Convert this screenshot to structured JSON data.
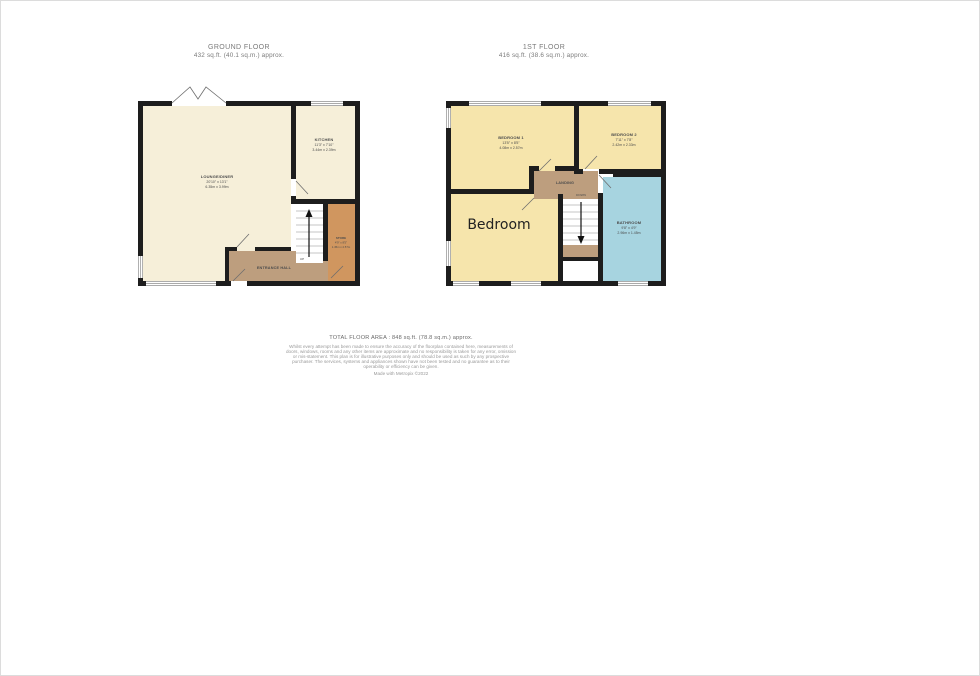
{
  "ground_floor": {
    "title": "GROUND FLOOR",
    "subtitle": "432 sq.ft. (40.1 sq.m.) approx.",
    "rooms": {
      "lounge": {
        "name": "LOUNGE/DINER",
        "imperial": "20'10\" x 13'1\"",
        "metric": "6.35m x 3.99m"
      },
      "kitchen": {
        "name": "KITCHEN",
        "imperial": "11'3\" x 7'10\"",
        "metric": "3.44m x 2.39m"
      },
      "entrance_hall": {
        "name": "ENTRANCE HALL"
      },
      "store": {
        "name": "STORE",
        "imperial": "4'9\" x 8'5\"",
        "metric": "1.45m x 2.57m"
      },
      "stairs_label": "UP"
    }
  },
  "first_floor": {
    "title": "1ST FLOOR",
    "subtitle": "416 sq.ft. (38.6 sq.m.) approx.",
    "rooms": {
      "bedroom1": {
        "name": "BEDROOM 1",
        "imperial": "13'5\" x 8'5\"",
        "metric": "4.08m x 2.57m"
      },
      "bedroom2": {
        "name": "BEDROOM 2",
        "imperial": "7'11\" x 7'8\"",
        "metric": "2.42m x 2.33m"
      },
      "bathroom": {
        "name": "BATHROOM",
        "imperial": "9'8\" x 4'9\"",
        "metric": "2.96m x 1.45m"
      },
      "landing": {
        "name": "LANDING"
      },
      "bedroom_annotation": "Bedroom",
      "stairs_label": "DOWN"
    }
  },
  "footer": {
    "total_area": "TOTAL FLOOR AREA : 848 sq.ft. (78.8 sq.m.) approx.",
    "disclaimer": "Whilst every attempt has been made to ensure the accuracy of the floorplan contained here, measurements of doors, windows, rooms and any other items are approximate and no responsibility is taken for any error, omission or mis-statement. This plan is for illustrative purposes only and should be used as such by any prospective purchaser. The services, systems and appliances shown have not been tested and no guarantee as to their operability or efficiency can be given.",
    "credit": "Made with Metropix ©2022"
  },
  "colors": {
    "wall": "#1d1d1d",
    "room_cream": "#F6EFD9",
    "room_yellow": "#F6E5AC",
    "hall_brown": "#BD9E7E",
    "store_orange": "#D0965F",
    "bath_blue": "#A7D4E0"
  }
}
